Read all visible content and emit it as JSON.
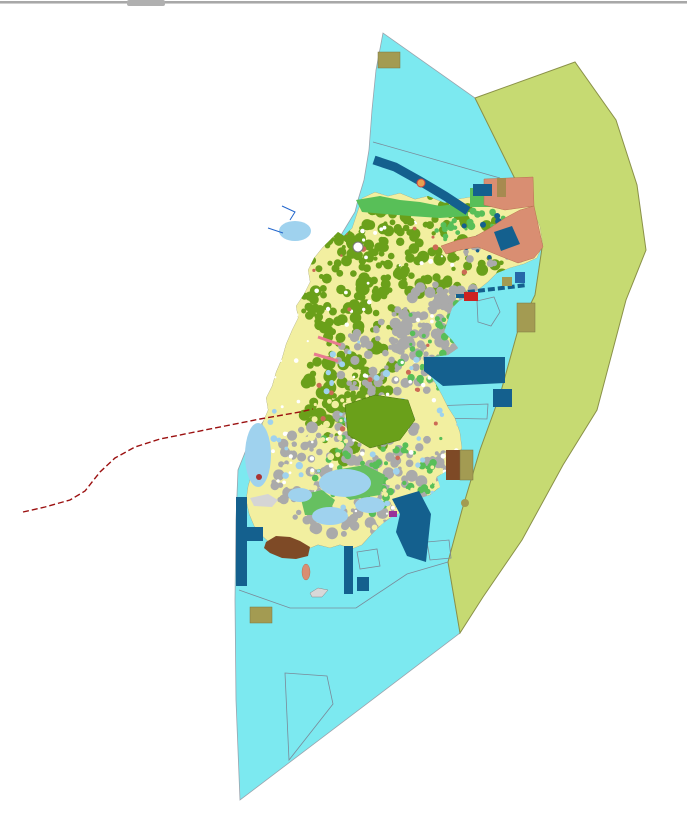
{
  "window": {
    "top_border_color": "#a8a8a8",
    "top_border_light": "#cfcfcf",
    "scroll_handle_color": "#b0b0b0"
  },
  "map": {
    "background": "#ffffff",
    "colors": {
      "water": "#7ce9f0",
      "coastal_zone": "#c6da72",
      "coastal_zone_edge": "#8a9148",
      "island_base": "#f2efa0",
      "forest": "#6aa01a",
      "urban": "#aaaaaa",
      "parkland": "#58bf58",
      "shallow": "#9fd2ee",
      "port_district": "#d98e72",
      "pier": "#14608e",
      "pier_bright": "#2668a8",
      "facility_khaki": "#a39b52",
      "facility_tan": "#a78a50",
      "facility_brown": "#7e4a26",
      "boundary_red": "#9b1010",
      "hairline": "#7a8a99",
      "stream_blue": "#2266cc",
      "road_pink": "#e87a90"
    },
    "island": {
      "texture_seed": 42,
      "outline": "362,198 375,192 388,196 400,193 415,199 428,196 445,203 458,199 470,197 482,192 492,189 502,193 514,197 526,204 534,213 540,226 543,245 537,258 524,264 510,268 497,273 488,282 478,290 468,296 459,301 452,308 448,320 444,332 452,340 458,348 448,355 432,357 425,362 428,372 436,384 442,395 448,407 455,418 460,432 462,448 457,462 448,470 437,477 440,487 430,495 420,498 412,506 402,512 393,516 382,524 372,534 362,545 352,549 340,545 330,548 318,545 308,549 296,553 284,552 272,545 262,536 254,526 249,514 246,500 248,486 252,472 257,458 262,444 266,432 262,424 268,410 266,398 272,386 276,372 282,358 286,344 292,330 298,318 296,306 304,294 310,282 308,270 314,258 322,248 330,240 338,232 344,236 352,228 356,216",
      "texture_regions": [
        {
          "name": "north-forest",
          "cx": 420,
          "cy": 248,
          "rx": 100,
          "ry": 52,
          "color": "#6aa01a",
          "count": 160,
          "rmin": 2,
          "rmax": 6
        },
        {
          "name": "nw-forest",
          "cx": 355,
          "cy": 295,
          "rx": 55,
          "ry": 58,
          "color": "#6aa01a",
          "count": 100,
          "rmin": 2,
          "rmax": 6
        },
        {
          "name": "central-forest",
          "cx": 350,
          "cy": 395,
          "rx": 48,
          "ry": 68,
          "color": "#6aa01a",
          "count": 120,
          "rmin": 2,
          "rmax": 7
        },
        {
          "name": "east-urban",
          "cx": 445,
          "cy": 330,
          "rx": 55,
          "ry": 48,
          "color": "#aaaaaa",
          "count": 140,
          "rmin": 2,
          "rmax": 6
        },
        {
          "name": "mid-urban",
          "cx": 395,
          "cy": 360,
          "rx": 60,
          "ry": 40,
          "color": "#aaaaaa",
          "count": 80,
          "rmin": 2,
          "rmax": 5
        },
        {
          "name": "south-urban",
          "cx": 360,
          "cy": 475,
          "rx": 90,
          "ry": 62,
          "color": "#aaaaaa",
          "count": 200,
          "rmin": 2,
          "rmax": 6
        },
        {
          "name": "ne-mottle",
          "cx": 500,
          "cy": 252,
          "rx": 35,
          "ry": 16,
          "color": "#aaaaaa",
          "count": 30,
          "rmin": 1.5,
          "rmax": 4
        },
        {
          "name": "south-green",
          "cx": 385,
          "cy": 465,
          "rx": 75,
          "ry": 55,
          "color": "#58bf58",
          "count": 70,
          "rmin": 1.5,
          "rmax": 4
        },
        {
          "name": "east-green",
          "cx": 445,
          "cy": 345,
          "rx": 50,
          "ry": 45,
          "color": "#58bf58",
          "count": 45,
          "rmin": 1.5,
          "rmax": 4
        },
        {
          "name": "ne-green",
          "cx": 480,
          "cy": 230,
          "rx": 45,
          "ry": 25,
          "color": "#58bf58",
          "count": 30,
          "rmin": 1.5,
          "rmax": 4
        },
        {
          "name": "yellow-speckle",
          "cx": 370,
          "cy": 460,
          "rx": 95,
          "ry": 70,
          "color": "#f2efa0",
          "count": 120,
          "rmin": 1.5,
          "rmax": 4
        },
        {
          "name": "white-speckle",
          "cx": 380,
          "cy": 380,
          "rx": 130,
          "ry": 170,
          "color": "#ffffff",
          "count": 130,
          "rmin": 1,
          "rmax": 2.5
        },
        {
          "name": "red-speckle",
          "cx": 400,
          "cy": 330,
          "rx": 110,
          "ry": 130,
          "color": "#cc6a55",
          "count": 30,
          "rmin": 1.2,
          "rmax": 3
        },
        {
          "name": "navy-speckle",
          "cx": 495,
          "cy": 238,
          "rx": 40,
          "ry": 22,
          "color": "#14608e",
          "count": 12,
          "rmin": 1.5,
          "rmax": 3.5
        },
        {
          "name": "lightblue-speckle",
          "cx": 370,
          "cy": 430,
          "rx": 100,
          "ry": 90,
          "color": "#9fd2ee",
          "count": 50,
          "rmin": 1.5,
          "rmax": 4
        }
      ]
    },
    "features": [
      {
        "name": "window-top-border-dark",
        "kind": "rect",
        "x": 0,
        "y": 1,
        "w": 687,
        "h": 2,
        "fill": "#a8a8a8"
      },
      {
        "name": "window-top-border-light",
        "kind": "rect",
        "x": 0,
        "y": 3,
        "w": 687,
        "h": 1,
        "fill": "#cfcfcf"
      },
      {
        "name": "scroll-handle",
        "kind": "rect",
        "x": 127,
        "y": 0,
        "w": 38,
        "h": 6,
        "rx": 2,
        "fill": "#b0b0b0",
        "inter": true
      },
      {
        "name": "water-area",
        "kind": "polygon",
        "points": "383,33 376,70 372,110 369,150 364,180 358,200 355,212 335,245 312,290 296,330 283,368 272,400 268,415 250,440 238,470 236,520 235,600 236,700 240,800 460,633 448,562 462,510 480,450 500,395 518,330 535,295 542,248 518,185 475,98",
        "fill": "#7ce9f0",
        "stroke": "#9aa4ae",
        "sw": 0.8
      },
      {
        "name": "coastal-zone-band",
        "kind": "polygon",
        "points": "475,98 575,62 616,120 637,185 646,250 626,300 597,410 563,465 522,540 483,597 460,633 448,562 462,510 480,450 500,395 518,330 535,295 542,248 518,185",
        "fill": "#c6da72",
        "stroke": "#8a9148",
        "sw": 1
      },
      {
        "name": "zone-hairline-nw",
        "kind": "polyline",
        "points": "373,142 500,178",
        "stroke": "#7a8a99",
        "sw": 0.8
      },
      {
        "name": "harbor-limit-line",
        "kind": "polyline",
        "points": "239,590 290,608 356,608 407,574 448,562",
        "stroke": "#7a8a99",
        "sw": 0.8
      },
      {
        "name": "zone-outline-south",
        "kind": "polygon",
        "points": "285,673 327,676 333,704 289,760",
        "fill": "none",
        "stroke": "#7a8a99",
        "sw": 0.8
      },
      {
        "name": "zone-outline-quad-1",
        "kind": "polygon",
        "points": "427,542 449,540 451,558 430,560",
        "fill": "none",
        "stroke": "#7a8a99",
        "sw": 0.8
      },
      {
        "name": "zone-outline-quad-2",
        "kind": "polygon",
        "points": "357,552 377,549 380,566 360,569",
        "fill": "none",
        "stroke": "#7a8a99",
        "sw": 0.8
      },
      {
        "name": "zone-outline-pentagon",
        "kind": "polygon",
        "points": "477,301 494,297 500,312 491,326 478,322",
        "fill": "none",
        "stroke": "#7a8a99",
        "sw": 0.8
      },
      {
        "name": "zone-outline-pier-quad",
        "kind": "polygon",
        "points": "431,406 488,404 487,419 432,418",
        "fill": "none",
        "stroke": "#7a8a99",
        "sw": 0.8
      },
      {
        "name": "island-landmass",
        "kind": "island"
      },
      {
        "name": "forest-block-central",
        "kind": "polygon",
        "points": "345,405 375,395 408,400 415,420 400,440 370,448 348,435",
        "fill": "#6aa01a",
        "stroke": "#4a7010",
        "sw": 0.5
      },
      {
        "name": "park-patch-south-1",
        "kind": "polygon",
        "points": "335,470 365,465 385,475 380,495 350,500 332,488",
        "fill": "#66c060"
      },
      {
        "name": "park-patch-south-2",
        "kind": "polygon",
        "points": "300,495 322,490 335,500 328,515 305,515",
        "fill": "#66c060"
      },
      {
        "name": "shallow-water-nw",
        "kind": "ellipse",
        "cx": 295,
        "cy": 231,
        "rx": 16,
        "ry": 10,
        "fill": "#9fd2ee"
      },
      {
        "name": "shallow-water-west",
        "kind": "ellipse",
        "cx": 258,
        "cy": 455,
        "rx": 13,
        "ry": 32,
        "fill": "#9fd2ee"
      },
      {
        "name": "shallow-water-south-1",
        "kind": "ellipse",
        "cx": 345,
        "cy": 483,
        "rx": 26,
        "ry": 14,
        "fill": "#9fd2ee"
      },
      {
        "name": "shallow-water-south-2",
        "kind": "ellipse",
        "cx": 330,
        "cy": 516,
        "rx": 18,
        "ry": 9,
        "fill": "#9fd2ee"
      },
      {
        "name": "shallow-water-south-3",
        "kind": "ellipse",
        "cx": 370,
        "cy": 505,
        "rx": 15,
        "ry": 8,
        "fill": "#9fd2ee"
      },
      {
        "name": "shallow-water-south-4",
        "kind": "ellipse",
        "cx": 300,
        "cy": 495,
        "rx": 12,
        "ry": 7,
        "fill": "#9fd2ee"
      },
      {
        "name": "park-strip-north-coast",
        "kind": "polygon",
        "points": "356,200 380,196 400,200 420,202 440,206 462,203 468,208 468,216 440,218 410,216 385,214 362,212",
        "fill": "#58bf58"
      },
      {
        "name": "park-rect-ne",
        "kind": "rect",
        "x": 470,
        "y": 188,
        "w": 26,
        "h": 19,
        "fill": "#58bf58"
      },
      {
        "name": "port-district-north",
        "kind": "polygon",
        "points": "484,179 533,177 534,206 505,210 484,205",
        "fill": "#d98e72",
        "stroke": "#b87050",
        "sw": 0.5
      },
      {
        "name": "port-district-band",
        "kind": "polygon",
        "points": "534,206 543,247 534,258 518,263 500,256 478,247 460,250 446,254 441,246 458,240 476,236 490,228 505,218 520,210",
        "fill": "#d98e72",
        "stroke": "#b87050",
        "sw": 0.5
      },
      {
        "name": "breakwater-nw",
        "kind": "polyline",
        "points": "374,160 395,167 420,181 445,196 468,211",
        "stroke": "#14608e",
        "sw": 9
      },
      {
        "name": "pier-rect-north",
        "kind": "rect",
        "x": 473,
        "y": 184,
        "w": 19,
        "h": 12,
        "fill": "#14608e"
      },
      {
        "name": "pier-square-ne",
        "kind": "polygon",
        "points": "494,232 512,226 520,244 501,251",
        "fill": "#14608e"
      },
      {
        "name": "pier-dashed-east",
        "kind": "polyline",
        "points": "468,292 527,285",
        "stroke": "#14608e",
        "sw": 4,
        "dash": "7 3"
      },
      {
        "name": "pier-bright-square",
        "kind": "rect",
        "x": 515,
        "y": 272,
        "w": 10,
        "h": 11,
        "fill": "#2668a8"
      },
      {
        "name": "pier-east-main",
        "kind": "polygon",
        "points": "424,357 505,357 505,383 443,386 424,371",
        "fill": "#14608e"
      },
      {
        "name": "pier-square-east",
        "kind": "rect",
        "x": 493,
        "y": 389,
        "w": 19,
        "h": 18,
        "fill": "#14608e"
      },
      {
        "name": "pier-se-main",
        "kind": "polygon",
        "points": "392,499 419,491 431,514 426,562 407,556 396,532 400,514",
        "fill": "#14608e"
      },
      {
        "name": "pier-bar-sw",
        "kind": "rect",
        "x": 236,
        "y": 497,
        "w": 11,
        "h": 89,
        "fill": "#14608e"
      },
      {
        "name": "pier-arm-sw",
        "kind": "rect",
        "x": 247,
        "y": 527,
        "w": 16,
        "h": 14,
        "fill": "#14608e"
      },
      {
        "name": "pier-bar-south",
        "kind": "rect",
        "x": 344,
        "y": 546,
        "w": 9,
        "h": 48,
        "fill": "#14608e"
      },
      {
        "name": "pier-square-south",
        "kind": "rect",
        "x": 357,
        "y": 577,
        "w": 12,
        "h": 14,
        "fill": "#14608e"
      },
      {
        "name": "facility-khaki-nw",
        "kind": "rect",
        "x": 378,
        "y": 52,
        "w": 22,
        "h": 16,
        "fill": "#a39b52",
        "stroke": "#7a7540",
        "sw": 0.5
      },
      {
        "name": "facility-tan-ne",
        "kind": "rect",
        "x": 497,
        "y": 178,
        "w": 9,
        "h": 19,
        "fill": "#a78a50"
      },
      {
        "name": "facility-khaki-east-small",
        "kind": "rect",
        "x": 502,
        "y": 277,
        "w": 10,
        "h": 9,
        "fill": "#a39b52"
      },
      {
        "name": "facility-khaki-east",
        "kind": "rect",
        "x": 517,
        "y": 303,
        "w": 18,
        "h": 29,
        "fill": "#a39b52",
        "stroke": "#7a7540",
        "sw": 0.5
      },
      {
        "name": "facility-khaki-sw",
        "kind": "rect",
        "x": 250,
        "y": 607,
        "w": 22,
        "h": 16,
        "fill": "#a39b52",
        "stroke": "#7a7540",
        "sw": 0.5
      },
      {
        "name": "facility-khaki-dot",
        "kind": "circle",
        "cx": 465,
        "cy": 503,
        "r": 4,
        "fill": "#a39b52"
      },
      {
        "name": "facility-brown-east",
        "kind": "rect",
        "x": 446,
        "y": 450,
        "w": 14,
        "h": 30,
        "fill": "#7e4a26"
      },
      {
        "name": "facility-khaki-east-2",
        "kind": "rect",
        "x": 460,
        "y": 450,
        "w": 13,
        "h": 30,
        "fill": "#a39b52",
        "stroke": "#7a7540",
        "sw": 0.5
      },
      {
        "name": "facility-brown-blob-sw",
        "kind": "polygon",
        "points": "266,542 276,536 290,537 300,541 310,547 308,556 296,559 282,558 270,553 264,548",
        "fill": "#7e4a26"
      },
      {
        "name": "gray-patch-west",
        "kind": "polygon",
        "points": "250,498 268,494 278,500 272,507 254,506",
        "fill": "#d5d5d5"
      },
      {
        "name": "boat-outline",
        "kind": "polygon",
        "points": "310,593 318,588 328,590 322,597 312,597",
        "fill": "#d8d8d8",
        "stroke": "#888888",
        "sw": 0.5
      },
      {
        "name": "salmon-blob-south",
        "kind": "ellipse",
        "cx": 306,
        "cy": 572,
        "rx": 4,
        "ry": 8,
        "fill": "#d98e72",
        "stroke": "#b87050",
        "sw": 0.5
      },
      {
        "name": "marker-orange-north",
        "kind": "circle",
        "cx": 421,
        "cy": 183,
        "r": 4,
        "fill": "#e8a050",
        "stroke": "#cc4444",
        "sw": 1
      },
      {
        "name": "marker-red-west",
        "kind": "circle",
        "cx": 259,
        "cy": 477,
        "r": 3,
        "fill": "#aa3333"
      },
      {
        "name": "marker-red-harbor",
        "kind": "rect",
        "x": 464,
        "y": 292,
        "w": 14,
        "h": 9,
        "fill": "#cc2222"
      },
      {
        "name": "marker-navy-harbor",
        "kind": "rect",
        "x": 456,
        "y": 294,
        "w": 8,
        "h": 4,
        "fill": "#14608e"
      },
      {
        "name": "marker-magenta-south",
        "kind": "rect",
        "x": 389,
        "y": 511,
        "w": 8,
        "h": 6,
        "fill": "#993399"
      },
      {
        "name": "circle-marker-nw",
        "kind": "circle",
        "cx": 358,
        "cy": 247,
        "r": 5,
        "fill": "#ffffff",
        "stroke": "#777777",
        "sw": 1
      },
      {
        "name": "stream-line-1",
        "kind": "polyline",
        "points": "282,206 295,212 290,220",
        "stroke": "#2266cc",
        "sw": 1
      },
      {
        "name": "stream-line-2",
        "kind": "polyline",
        "points": "268,228 283,233",
        "stroke": "#2266cc",
        "sw": 1
      },
      {
        "name": "road-pink-1",
        "kind": "polyline",
        "points": "318,337 341,345",
        "stroke": "#e87a90",
        "sw": 3
      },
      {
        "name": "road-pink-2",
        "kind": "polyline",
        "points": "314,354 338,361",
        "stroke": "#e87a90",
        "sw": 3
      },
      {
        "name": "boundary-red-dashed",
        "kind": "polyline",
        "points": "23,512 45,507 70,500 85,491 100,472 115,458 135,447 160,439 190,433 225,426 260,419 300,412 313,409",
        "stroke": "#9b1010",
        "sw": 1.4,
        "dash": "6 3"
      }
    ]
  }
}
